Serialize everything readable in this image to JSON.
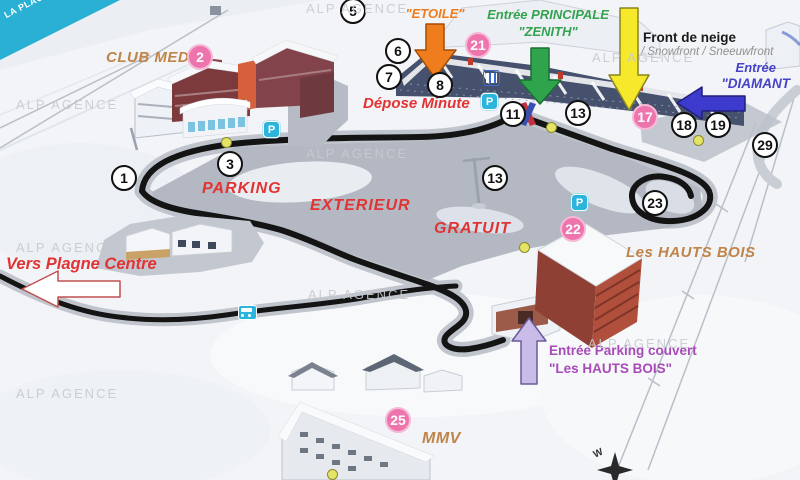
{
  "banner": {
    "title": "LA PLAGNE"
  },
  "watermark_text": "ALP AGENCE",
  "watermarks": [
    {
      "x": 306,
      "y": 1
    },
    {
      "x": 16,
      "y": 97
    },
    {
      "x": 592,
      "y": 50
    },
    {
      "x": 306,
      "y": 146
    },
    {
      "x": 16,
      "y": 240
    },
    {
      "x": 308,
      "y": 287
    },
    {
      "x": 588,
      "y": 336
    },
    {
      "x": 16,
      "y": 386
    }
  ],
  "labels": {
    "club_med": "CLUB MED",
    "entree_etoile_1": "Entrée",
    "entree_etoile_2": "\"ETOILE\"",
    "entree_principale_1": "Entrée PRINCIPALE",
    "entree_principale_2": "\"ZENITH\"",
    "front_de_neige": "Front de neige",
    "front_de_neige_sub": "/ Snowfront / Sneeuwfront",
    "entree_diamant_1": "Entrée",
    "entree_diamant_2": "\"DIAMANT",
    "depose_minute": "Dépose Minute",
    "parking_line1": "PARKING",
    "parking_line2": "EXTERIEUR",
    "parking_line3": "GRATUIT",
    "les_hauts_bois": "Les HAUTS BOIS",
    "vers_plagne_centre": "Vers Plagne Centre",
    "entree_parking_couvert_1": "Entrée Parking couvert",
    "entree_parking_couvert_2": "\"Les HAUTS BOIS\"",
    "mmv": "MMV",
    "compass_w": "W"
  },
  "markers": [
    {
      "n": "1",
      "t": "w",
      "x": 124,
      "y": 178
    },
    {
      "n": "2",
      "t": "p",
      "x": 200,
      "y": 57
    },
    {
      "n": "3",
      "t": "w",
      "x": 230,
      "y": 164
    },
    {
      "n": "5",
      "t": "w",
      "x": 353,
      "y": 11
    },
    {
      "n": "6",
      "t": "w",
      "x": 398,
      "y": 51
    },
    {
      "n": "7",
      "t": "w",
      "x": 389,
      "y": 77
    },
    {
      "n": "8",
      "t": "w",
      "x": 440,
      "y": 85
    },
    {
      "n": "11",
      "t": "w",
      "x": 513,
      "y": 114
    },
    {
      "n": "13",
      "t": "w",
      "x": 578,
      "y": 113
    },
    {
      "n": "13",
      "t": "w",
      "x": 495,
      "y": 178
    },
    {
      "n": "17",
      "t": "p",
      "x": 645,
      "y": 117
    },
    {
      "n": "18",
      "t": "w",
      "x": 684,
      "y": 125
    },
    {
      "n": "19",
      "t": "w",
      "x": 718,
      "y": 125
    },
    {
      "n": "21",
      "t": "p",
      "x": 478,
      "y": 45
    },
    {
      "n": "22",
      "t": "p",
      "x": 573,
      "y": 229
    },
    {
      "n": "23",
      "t": "w",
      "x": 655,
      "y": 203
    },
    {
      "n": "25",
      "t": "p",
      "x": 398,
      "y": 420
    },
    {
      "n": "29",
      "t": "w",
      "x": 765,
      "y": 145
    }
  ],
  "yellow_dots": [
    {
      "x": 226,
      "y": 142
    },
    {
      "x": 551,
      "y": 127
    },
    {
      "x": 698,
      "y": 140
    },
    {
      "x": 524,
      "y": 247
    },
    {
      "x": 332,
      "y": 474
    }
  ],
  "parking_icons": [
    {
      "x": 271,
      "y": 129
    },
    {
      "x": 489,
      "y": 101
    },
    {
      "x": 579,
      "y": 202
    }
  ],
  "icons": {
    "parking_label": "P",
    "bus_icon": "bus pictogram",
    "ticket_office_icon": "ticket-office pictogram",
    "ski_school_icon": "crossed red/blue flags"
  },
  "colors": {
    "banner_cyan": "#29b0d4",
    "road_black": "#141414",
    "road_gray": "#c0c5cd",
    "lot_gray": "#b3b8c2",
    "red_label": "#e23333",
    "tan_label": "#c08448",
    "green_label": "#35a24f",
    "blue_label": "#4743c6",
    "purple_label": "#a84ab8",
    "gray_label": "#909090",
    "watermark": "#c7cacf",
    "arrow_orange": "#ef7d1e",
    "arrow_green": "#2fa44c",
    "arrow_yellow": "#f6e92b",
    "arrow_blue": "#3d3bcd",
    "arrow_lavender": "#c9bce8",
    "pink_marker": "#ee74ad",
    "yellow_dot": "#e6e465",
    "cyan_icon": "#2cb5dc",
    "building_dark": "#46516e",
    "building_red": "#7d3a3d",
    "hautsbois_red": "#b0503c"
  }
}
